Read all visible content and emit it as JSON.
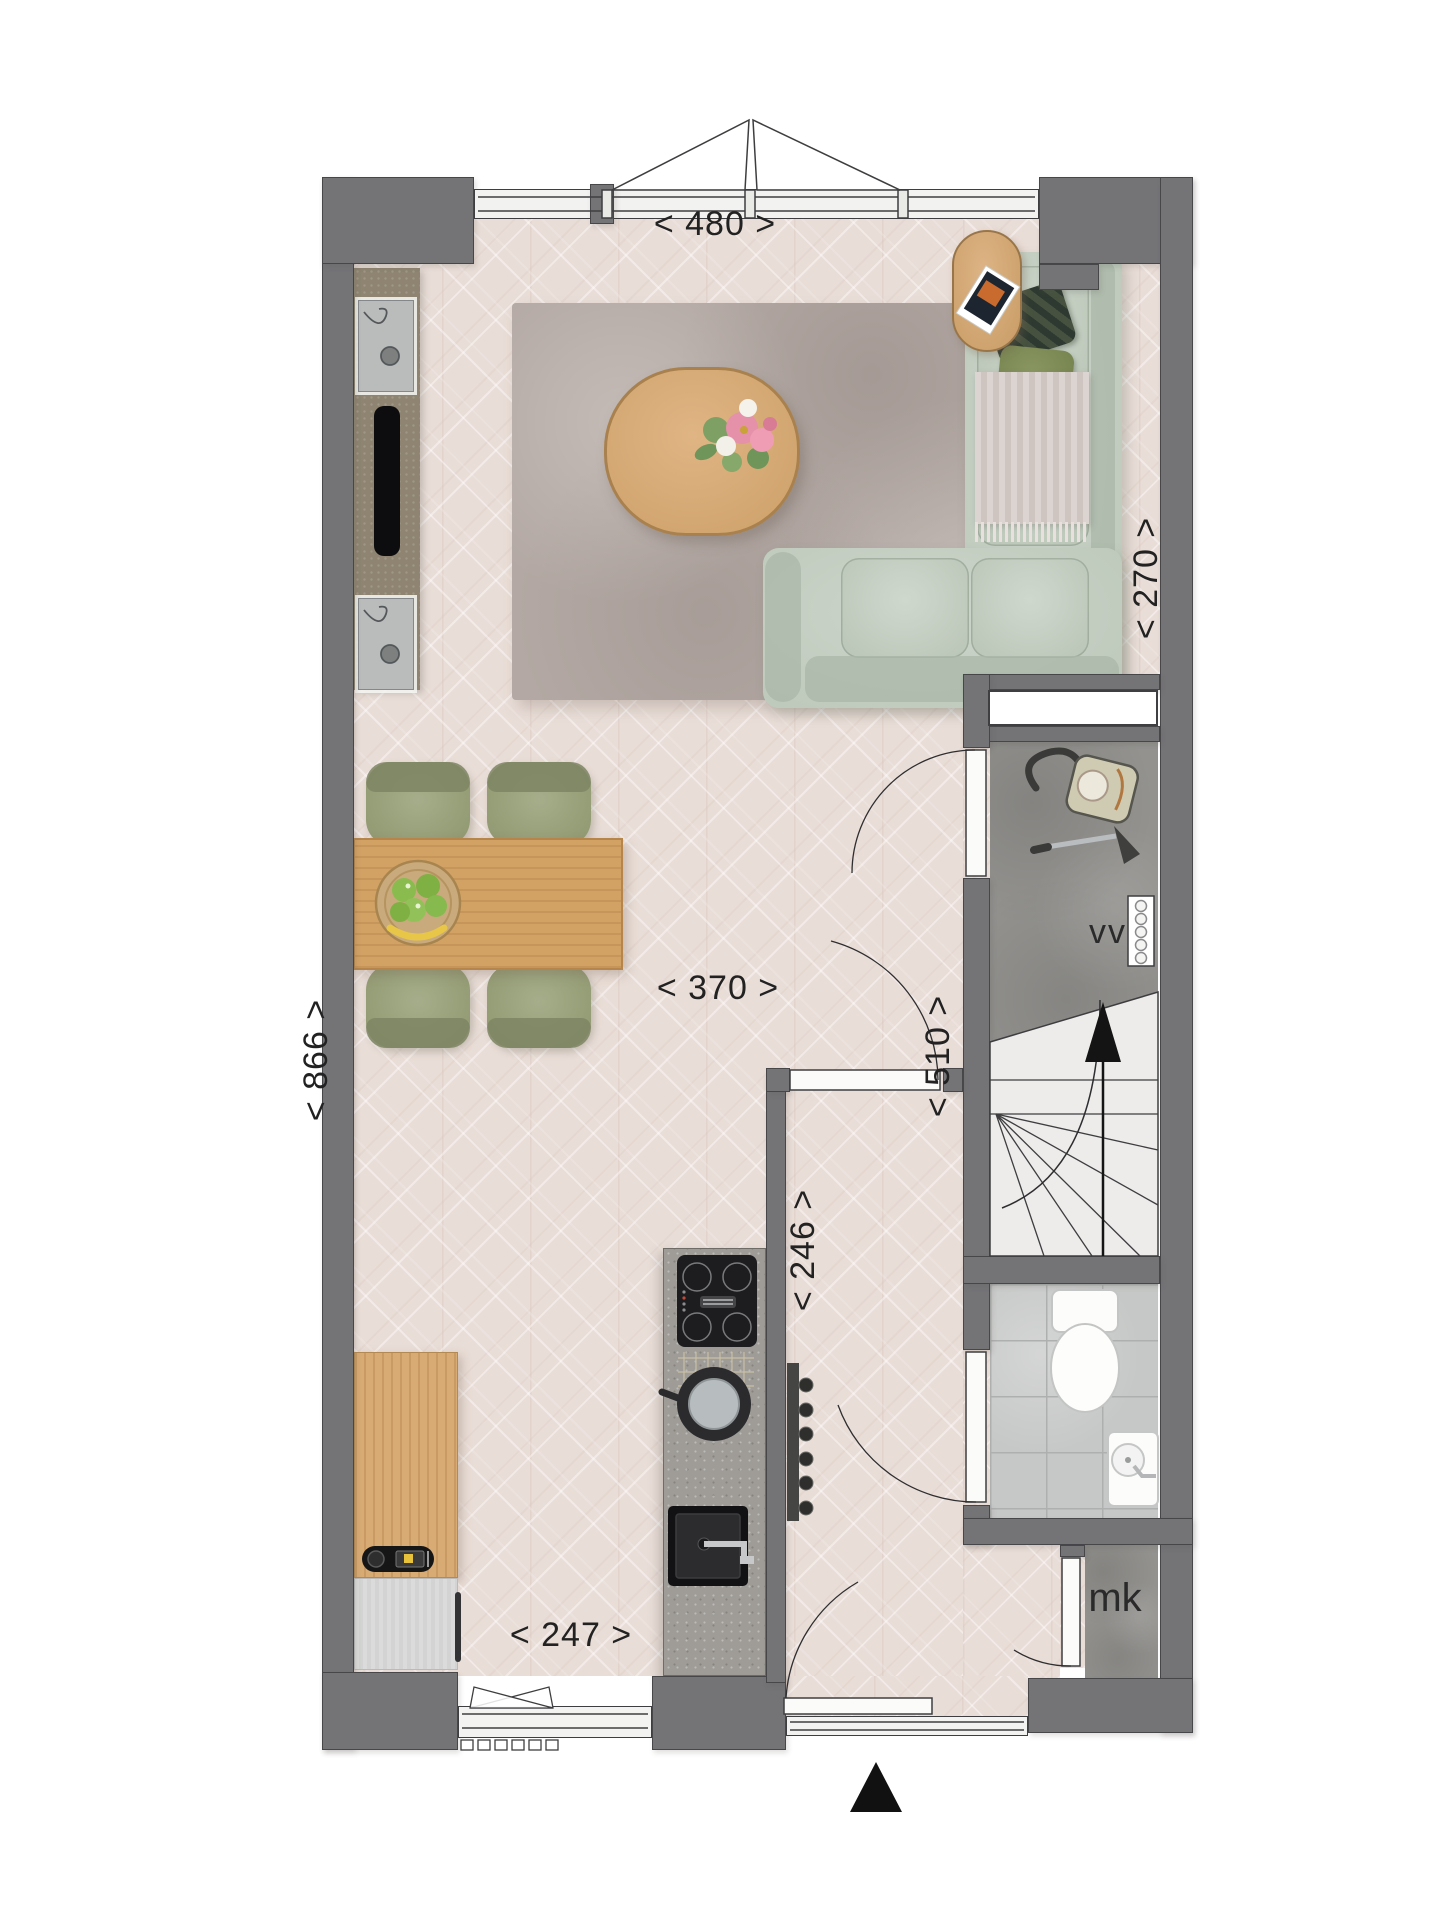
{
  "plan": {
    "dimensions": {
      "top_width": "< 480 >",
      "living_depth": "< 270 >",
      "living_width": "< 370 >",
      "hall_depth": "< 510 >",
      "total_depth": "< 866 >",
      "kitchen_depth": "< 246 >",
      "kitchen_width": "< 247 >"
    },
    "room_labels": {
      "mechanical_vent": "vv",
      "meter_closet": "mk"
    },
    "colors": {
      "wall": "#747477",
      "outline": "#3a3a3c",
      "wood_floor": "#e9ddd7",
      "concrete_floor": "#93928f",
      "tile_floor": "#c6c8c7",
      "sofa_sage": "#c2ccc0",
      "oak": "#d2a265",
      "rug": "#b3a8a3",
      "stair_tread": "#edecea"
    }
  }
}
